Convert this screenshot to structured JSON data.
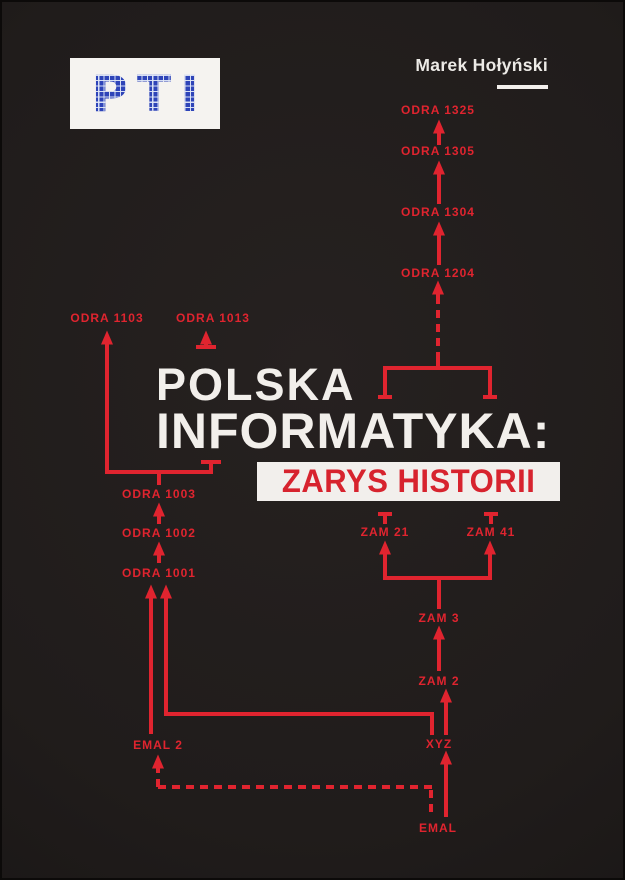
{
  "cover": {
    "logo": {
      "text": "PTI"
    },
    "author": {
      "name": "Marek Hołyński"
    },
    "title": {
      "line1": "POLSKA",
      "line2": "INFORMATYKA:",
      "subtitle": "ZARYS HISTORII"
    },
    "colors": {
      "background": "#201c1b",
      "diagram_red": "#e0242f",
      "title_white": "#f2efeb",
      "subtitle_red": "#d7232e",
      "logo_blue": "#2e44b8",
      "logo_bg": "#f5f3f0"
    }
  },
  "diagram": {
    "color": "#e0242f",
    "nodes": [
      {
        "id": "odra-1325",
        "label": "ODRA 1325",
        "x": 438,
        "y": 110
      },
      {
        "id": "odra-1305",
        "label": "ODRA 1305",
        "x": 438,
        "y": 151
      },
      {
        "id": "odra-1304",
        "label": "ODRA 1304",
        "x": 438,
        "y": 212
      },
      {
        "id": "odra-1204",
        "label": "ODRA 1204",
        "x": 438,
        "y": 273
      },
      {
        "id": "odra-1103",
        "label": "ODRA 1103",
        "x": 107,
        "y": 318
      },
      {
        "id": "odra-1013",
        "label": "ODRA 1013",
        "x": 213,
        "y": 318
      },
      {
        "id": "odra-1003",
        "label": "ODRA 1003",
        "x": 159,
        "y": 494
      },
      {
        "id": "odra-1002",
        "label": "ODRA 1002",
        "x": 159,
        "y": 533
      },
      {
        "id": "odra-1001",
        "label": "ODRA 1001",
        "x": 159,
        "y": 573
      },
      {
        "id": "zam-21",
        "label": "ZAM 21",
        "x": 385,
        "y": 532
      },
      {
        "id": "zam-41",
        "label": "ZAM 41",
        "x": 491,
        "y": 532
      },
      {
        "id": "zam-3",
        "label": "ZAM 3",
        "x": 439,
        "y": 618
      },
      {
        "id": "zam-2",
        "label": "ZAM 2",
        "x": 439,
        "y": 681
      },
      {
        "id": "xyz",
        "label": "XYZ",
        "x": 439,
        "y": 744
      },
      {
        "id": "emal-2",
        "label": "EMAL 2",
        "x": 158,
        "y": 745
      },
      {
        "id": "emal",
        "label": "EMAL",
        "x": 438,
        "y": 828
      }
    ],
    "segments": [
      {
        "x1": 439,
        "y1": 145,
        "x2": 439,
        "y2": 131,
        "arrow": true
      },
      {
        "x1": 439,
        "y1": 204,
        "x2": 439,
        "y2": 172,
        "arrow": true
      },
      {
        "x1": 439,
        "y1": 265,
        "x2": 439,
        "y2": 233,
        "arrow": true
      },
      {
        "x1": 438,
        "y1": 360,
        "x2": 438,
        "y2": 300,
        "dashed": true
      },
      {
        "x1": 438,
        "y1": 301,
        "x2": 438,
        "y2": 292,
        "arrow": true
      },
      {
        "x1": 385,
        "y1": 368,
        "x2": 490,
        "y2": 368
      },
      {
        "x1": 438,
        "y1": 370,
        "x2": 438,
        "y2": 359
      },
      {
        "x1": 385,
        "y1": 366,
        "x2": 385,
        "y2": 397
      },
      {
        "x1": 490,
        "y1": 366,
        "x2": 490,
        "y2": 397
      },
      {
        "x1": 378,
        "y1": 397,
        "x2": 392,
        "y2": 397
      },
      {
        "x1": 483,
        "y1": 397,
        "x2": 497,
        "y2": 397
      },
      {
        "x1": 196,
        "y1": 347,
        "x2": 216,
        "y2": 347
      },
      {
        "x1": 206,
        "y1": 346,
        "x2": 206,
        "y2": 342,
        "arrow": true
      },
      {
        "x1": 107,
        "y1": 474,
        "x2": 107,
        "y2": 342,
        "arrow": true
      },
      {
        "x1": 105,
        "y1": 472,
        "x2": 211,
        "y2": 472
      },
      {
        "x1": 211,
        "y1": 474,
        "x2": 211,
        "y2": 463
      },
      {
        "x1": 201,
        "y1": 462,
        "x2": 221,
        "y2": 462
      },
      {
        "x1": 159,
        "y1": 472,
        "x2": 159,
        "y2": 485
      },
      {
        "x1": 159,
        "y1": 524,
        "x2": 159,
        "y2": 514,
        "arrow": true
      },
      {
        "x1": 159,
        "y1": 563,
        "x2": 159,
        "y2": 553,
        "arrow": true
      },
      {
        "x1": 151,
        "y1": 734,
        "x2": 151,
        "y2": 596,
        "arrow": true
      },
      {
        "x1": 432,
        "y1": 735,
        "x2": 432,
        "y2": 712
      },
      {
        "x1": 434,
        "y1": 714,
        "x2": 164,
        "y2": 714
      },
      {
        "x1": 166,
        "y1": 716,
        "x2": 166,
        "y2": 596,
        "arrow": true
      },
      {
        "x1": 446,
        "y1": 735,
        "x2": 446,
        "y2": 700,
        "arrow": true
      },
      {
        "x1": 439,
        "y1": 671,
        "x2": 439,
        "y2": 637,
        "arrow": true
      },
      {
        "x1": 439,
        "y1": 609,
        "x2": 439,
        "y2": 576
      },
      {
        "x1": 383,
        "y1": 578,
        "x2": 492,
        "y2": 578
      },
      {
        "x1": 385,
        "y1": 580,
        "x2": 385,
        "y2": 552,
        "arrow": true
      },
      {
        "x1": 490,
        "y1": 580,
        "x2": 490,
        "y2": 552,
        "arrow": true
      },
      {
        "x1": 446,
        "y1": 817,
        "x2": 446,
        "y2": 762,
        "arrow": true
      },
      {
        "x1": 431,
        "y1": 812,
        "x2": 431,
        "y2": 787,
        "dashed": true
      },
      {
        "x1": 432,
        "y1": 787,
        "x2": 158,
        "y2": 787,
        "dashed": true
      },
      {
        "x1": 158,
        "y1": 787,
        "x2": 158,
        "y2": 772,
        "dashed": true
      },
      {
        "x1": 158,
        "y1": 773,
        "x2": 158,
        "y2": 766,
        "arrow": true
      },
      {
        "x1": 378,
        "y1": 514,
        "x2": 392,
        "y2": 514
      },
      {
        "x1": 385,
        "y1": 515,
        "x2": 385,
        "y2": 524
      },
      {
        "x1": 484,
        "y1": 514,
        "x2": 498,
        "y2": 514
      },
      {
        "x1": 491,
        "y1": 515,
        "x2": 491,
        "y2": 524
      }
    ]
  }
}
